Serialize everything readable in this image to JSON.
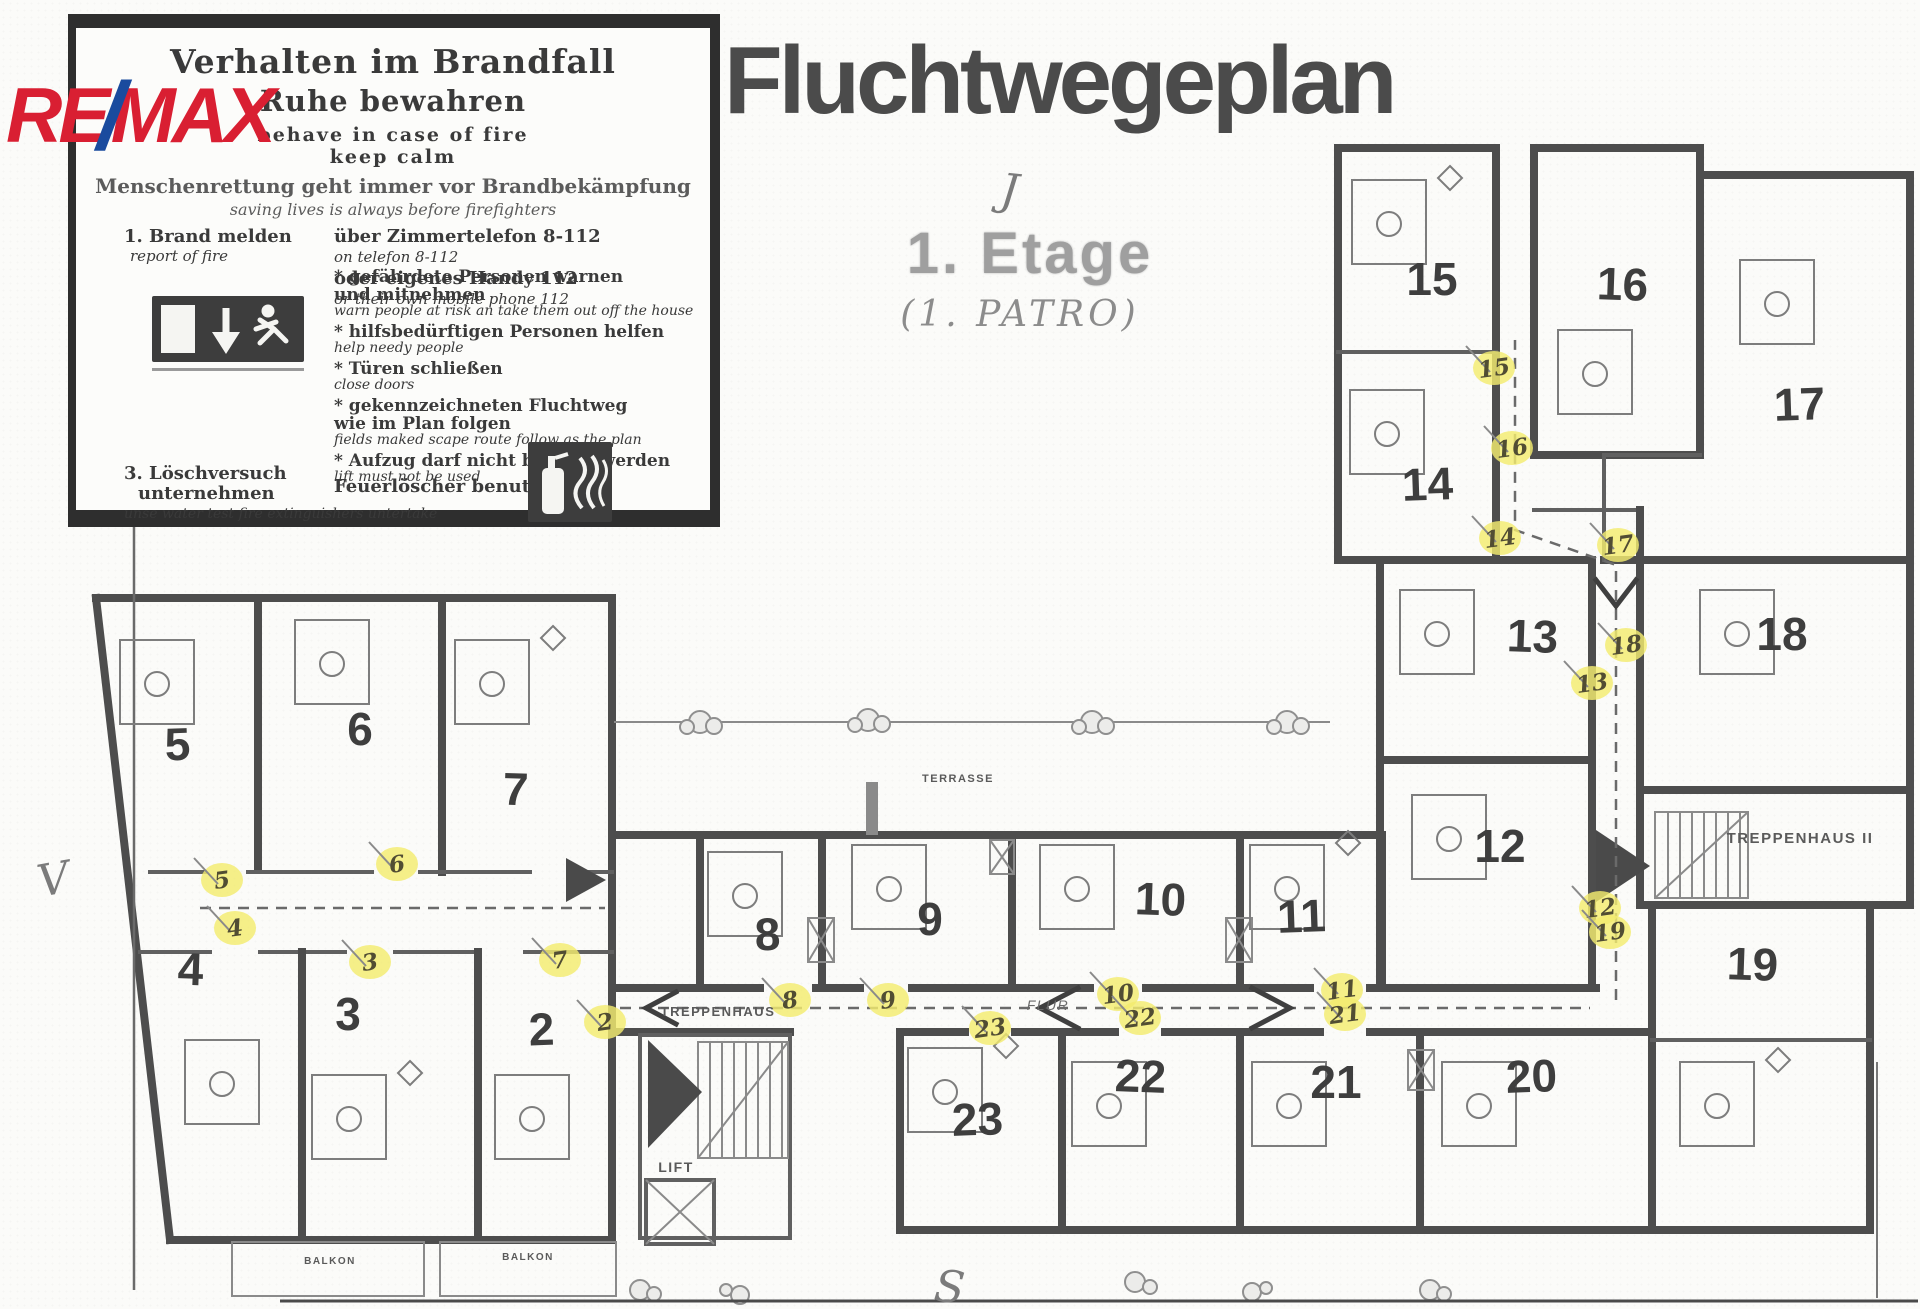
{
  "logo": {
    "re": "RE",
    "slash": "/",
    "max": "MAX"
  },
  "header": {
    "title": "Fluchtwegeplan",
    "floor_stamp": "1. Etage",
    "floor_handwritten": "(1. PATRO)"
  },
  "instruction_box": {
    "title_de": "Verhalten im Brandfall",
    "subtitle_de": "Ruhe bewahren",
    "subtitle_en_line1": "behave in case of fire",
    "subtitle_en_line2": "keep calm",
    "principle_de": "Menschenrettung geht immer vor Brandbekämpfung",
    "principle_en": "saving lives is always before firefighters",
    "step1_de": "1. Brand melden",
    "step1_en": "report of fire",
    "phone_de_1": "über Zimmertelefon  8-112",
    "phone_en_1": "on telefon 8-112",
    "phone_de_2": "oder eigenes Handy  112",
    "phone_en_2": "or their own mobile phone 112",
    "bullets": [
      {
        "de": "* gefährdete Personen warnen",
        "de2": "und mitnehmen",
        "en": "warn people at risk an take them out off the house"
      },
      {
        "de": "* hilfsbedürftigen Personen helfen",
        "en": "help needy people"
      },
      {
        "de": "* Türen schließen",
        "en": "close doors"
      },
      {
        "de": "* gekennzeichneten Fluchtweg",
        "de2": "wie im Plan folgen",
        "en": "fields maked scape route follow as the plan"
      },
      {
        "de": "* Aufzug darf nicht benutzt werden",
        "en": "lift must not be used"
      }
    ],
    "step3_de_line1": "3. Löschversuch",
    "step3_de_line2": "unternehmen",
    "step3_en": "unse water test fire extinguishers untertake",
    "step3_action_de": "Feuerlöscher benutzen",
    "icons": [
      "emergency-exit-sign",
      "fire-extinguisher-sign"
    ]
  },
  "plan": {
    "compass": {
      "top": "J",
      "left": "V",
      "bottom": "S"
    },
    "rooms": [
      {
        "n": "2",
        "x": 542,
        "y": 1045,
        "bed": [
          495,
          1075
        ]
      },
      {
        "n": "3",
        "x": 348,
        "y": 1030,
        "bed": [
          312,
          1075
        ]
      },
      {
        "n": "4",
        "x": 190,
        "y": 985,
        "bed": [
          185,
          1040
        ]
      },
      {
        "n": "5",
        "x": 178,
        "y": 760,
        "bed": [
          120,
          640
        ]
      },
      {
        "n": "6",
        "x": 360,
        "y": 745,
        "bed": [
          295,
          620
        ]
      },
      {
        "n": "7",
        "x": 515,
        "y": 805,
        "bed": [
          455,
          640
        ]
      },
      {
        "n": "8",
        "x": 768,
        "y": 950,
        "bed": [
          708,
          852
        ]
      },
      {
        "n": "9",
        "x": 930,
        "y": 935,
        "bed": [
          852,
          845
        ]
      },
      {
        "n": "10",
        "x": 1160,
        "y": 915,
        "bed": [
          1040,
          845
        ]
      },
      {
        "n": "11",
        "x": 1302,
        "y": 932,
        "bed": [
          1250,
          845
        ]
      },
      {
        "n": "12",
        "x": 1500,
        "y": 862,
        "bed": [
          1412,
          795
        ]
      },
      {
        "n": "13",
        "x": 1532,
        "y": 652,
        "bed": [
          1400,
          590
        ]
      },
      {
        "n": "14",
        "x": 1428,
        "y": 500,
        "bed": [
          1350,
          390
        ]
      },
      {
        "n": "15",
        "x": 1432,
        "y": 295,
        "bed": [
          1352,
          180
        ]
      },
      {
        "n": "16",
        "x": 1622,
        "y": 300,
        "bed": [
          1558,
          330
        ]
      },
      {
        "n": "17",
        "x": 1800,
        "y": 420,
        "bed": [
          1740,
          260
        ]
      },
      {
        "n": "18",
        "x": 1782,
        "y": 650,
        "bed": [
          1700,
          590
        ]
      },
      {
        "n": "19",
        "x": 1752,
        "y": 980,
        "bed": [
          1680,
          1062
        ]
      },
      {
        "n": "20",
        "x": 1532,
        "y": 1092,
        "bed": [
          1442,
          1062
        ]
      },
      {
        "n": "21",
        "x": 1336,
        "y": 1098,
        "bed": [
          1252,
          1062
        ]
      },
      {
        "n": "22",
        "x": 1140,
        "y": 1092,
        "bed": [
          1072,
          1062
        ]
      },
      {
        "n": "23",
        "x": 978,
        "y": 1135,
        "bed": [
          908,
          1048
        ]
      }
    ],
    "route_markers": [
      {
        "n": "2",
        "x": 605,
        "y": 1022
      },
      {
        "n": "3",
        "x": 370,
        "y": 962
      },
      {
        "n": "4",
        "x": 235,
        "y": 928
      },
      {
        "n": "5",
        "x": 222,
        "y": 880
      },
      {
        "n": "6",
        "x": 397,
        "y": 864
      },
      {
        "n": "7",
        "x": 560,
        "y": 960
      },
      {
        "n": "8",
        "x": 790,
        "y": 1000
      },
      {
        "n": "9",
        "x": 888,
        "y": 1000
      },
      {
        "n": "10",
        "x": 1118,
        "y": 994
      },
      {
        "n": "11",
        "x": 1342,
        "y": 990
      },
      {
        "n": "12",
        "x": 1600,
        "y": 908
      },
      {
        "n": "13",
        "x": 1592,
        "y": 683
      },
      {
        "n": "14",
        "x": 1500,
        "y": 538
      },
      {
        "n": "15",
        "x": 1494,
        "y": 368
      },
      {
        "n": "16",
        "x": 1512,
        "y": 448
      },
      {
        "n": "17",
        "x": 1618,
        "y": 545
      },
      {
        "n": "18",
        "x": 1626,
        "y": 645
      },
      {
        "n": "19",
        "x": 1610,
        "y": 932
      },
      {
        "n": "21",
        "x": 1345,
        "y": 1014
      },
      {
        "n": "22",
        "x": 1140,
        "y": 1018
      },
      {
        "n": "23",
        "x": 990,
        "y": 1028
      }
    ],
    "labels": [
      {
        "t": "TREPPENHAUS",
        "x": 718,
        "y": 1016,
        "s": 13
      },
      {
        "t": "LIFT",
        "x": 676,
        "y": 1172,
        "s": 14
      },
      {
        "t": "FLUR",
        "x": 1048,
        "y": 1010,
        "s": 14,
        "i": true
      },
      {
        "t": "TREPPENHAUS II",
        "x": 1800,
        "y": 843,
        "s": 15
      },
      {
        "t": "TERRASSE",
        "x": 958,
        "y": 782,
        "s": 11
      },
      {
        "t": "BALKON",
        "x": 330,
        "y": 1264,
        "s": 10
      },
      {
        "t": "BALKON",
        "x": 528,
        "y": 1260,
        "s": 10
      }
    ],
    "colors": {
      "marker_yellow": "#f3ec6f",
      "wall_ink": "#4d4d4d",
      "logo_red": "#d91f32",
      "logo_blue": "#1a4b9e"
    }
  }
}
